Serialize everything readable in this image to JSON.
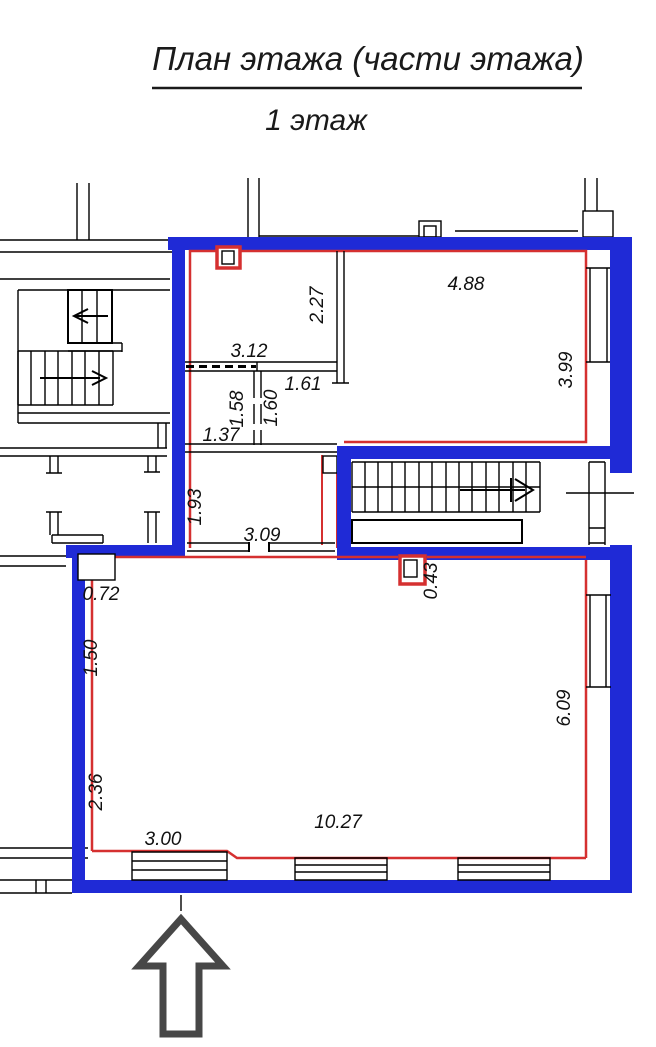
{
  "title": {
    "main": "План этажа (части этажа)",
    "subtitle": "1 этаж"
  },
  "colors": {
    "outer_wall_blue": "#1f2ad6",
    "inner_contour_red": "#d53030",
    "background_lines_black": "#000000",
    "north_arrow_gray": "#474747"
  },
  "dimensions": {
    "d227": "2.27",
    "d488": "4.88",
    "d399": "3.99",
    "d312": "3.12",
    "d161": "1.61",
    "d158": "1.58",
    "d160": "1.60",
    "d137": "1.37",
    "d193": "1.93",
    "d309": "3.09",
    "d072": "0.72",
    "d043": "0.43",
    "d150": "1.50",
    "d236": "2.36",
    "d300": "3.00",
    "d1027": "10.27",
    "d609": "6.09"
  },
  "symbols": {
    "north_arrow": "up-arrow",
    "stair_direction_upper_left": "arrow-left",
    "stair_direction_lower_left": "arrow-right",
    "stair_direction_main": "arrow-right"
  }
}
